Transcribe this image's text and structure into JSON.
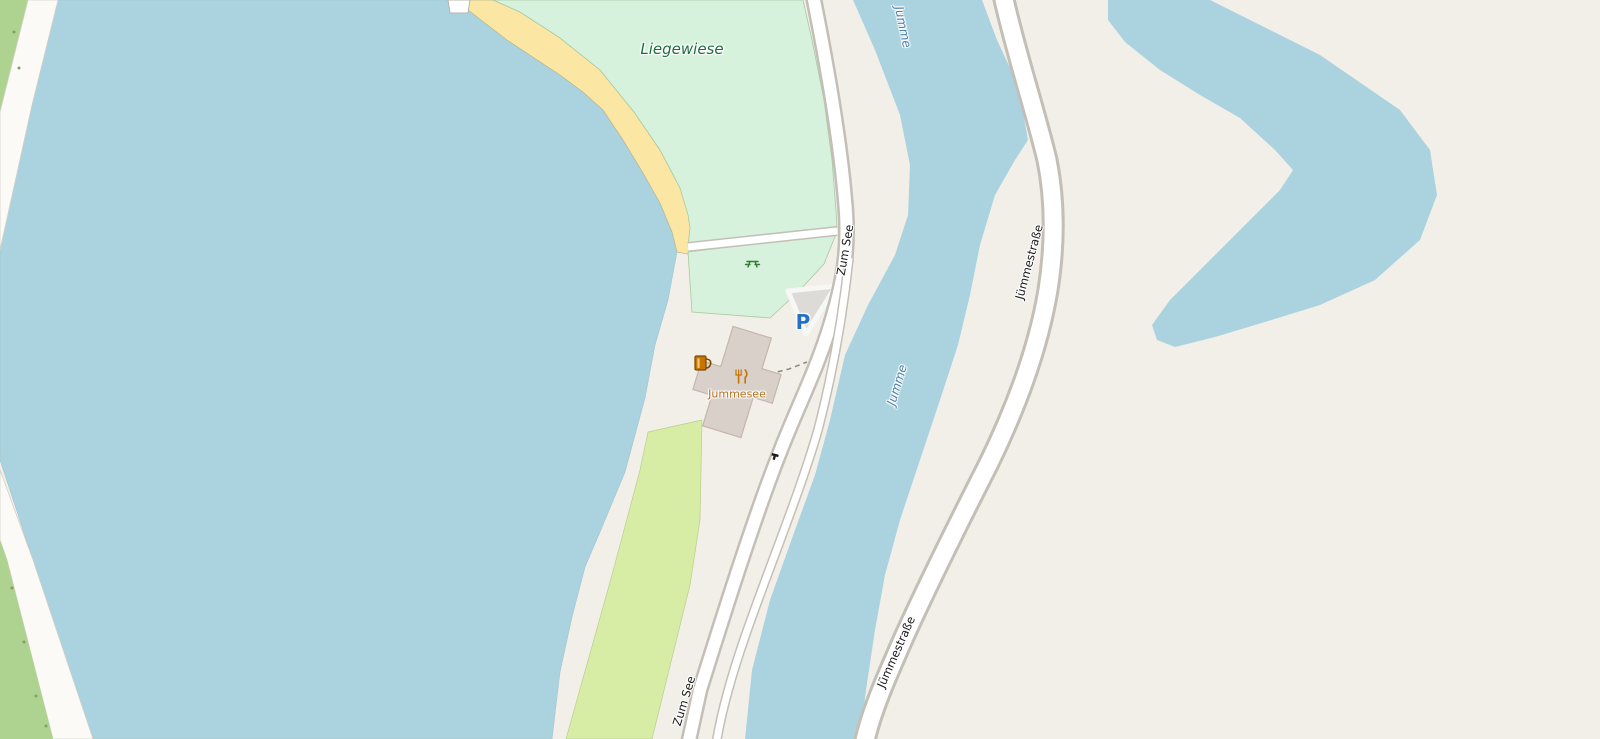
{
  "map": {
    "labels": {
      "meadow": "Liegewiese",
      "river": "Jumme",
      "road_zum_see": "Zum See",
      "road_jummestrasse": "Jümmestraße",
      "poi_jummesee": "Jummesee",
      "parking": "P"
    },
    "icons": {
      "parking": "parking-P",
      "pub": "beer-mug",
      "restaurant": "fork-and-knife",
      "picnic_site": "picnic-table",
      "gate": "gate-marker"
    },
    "colors": {
      "water": "#aad3df",
      "land": "#f2efe9",
      "meadow_mint": "#d6f2dc",
      "grass_field": "#d7eda6",
      "scrub": "#aed28f",
      "beach": "#fbe7a3",
      "building_fill": "#d9d0c9",
      "building_outline": "#c4b6ab",
      "road_fill": "#ffffff",
      "road_casing": "#c3bfb7",
      "parking_area": "#dcdbd7",
      "water_label": "#4d7fa8",
      "meadow_label": "#1d6b42",
      "poi_label": "#b4701c",
      "road_label": "#1a1a1a",
      "parking_blue": "#2470c8",
      "poi_icon_orange": "#c77400",
      "picnic_green": "#377d37"
    }
  }
}
